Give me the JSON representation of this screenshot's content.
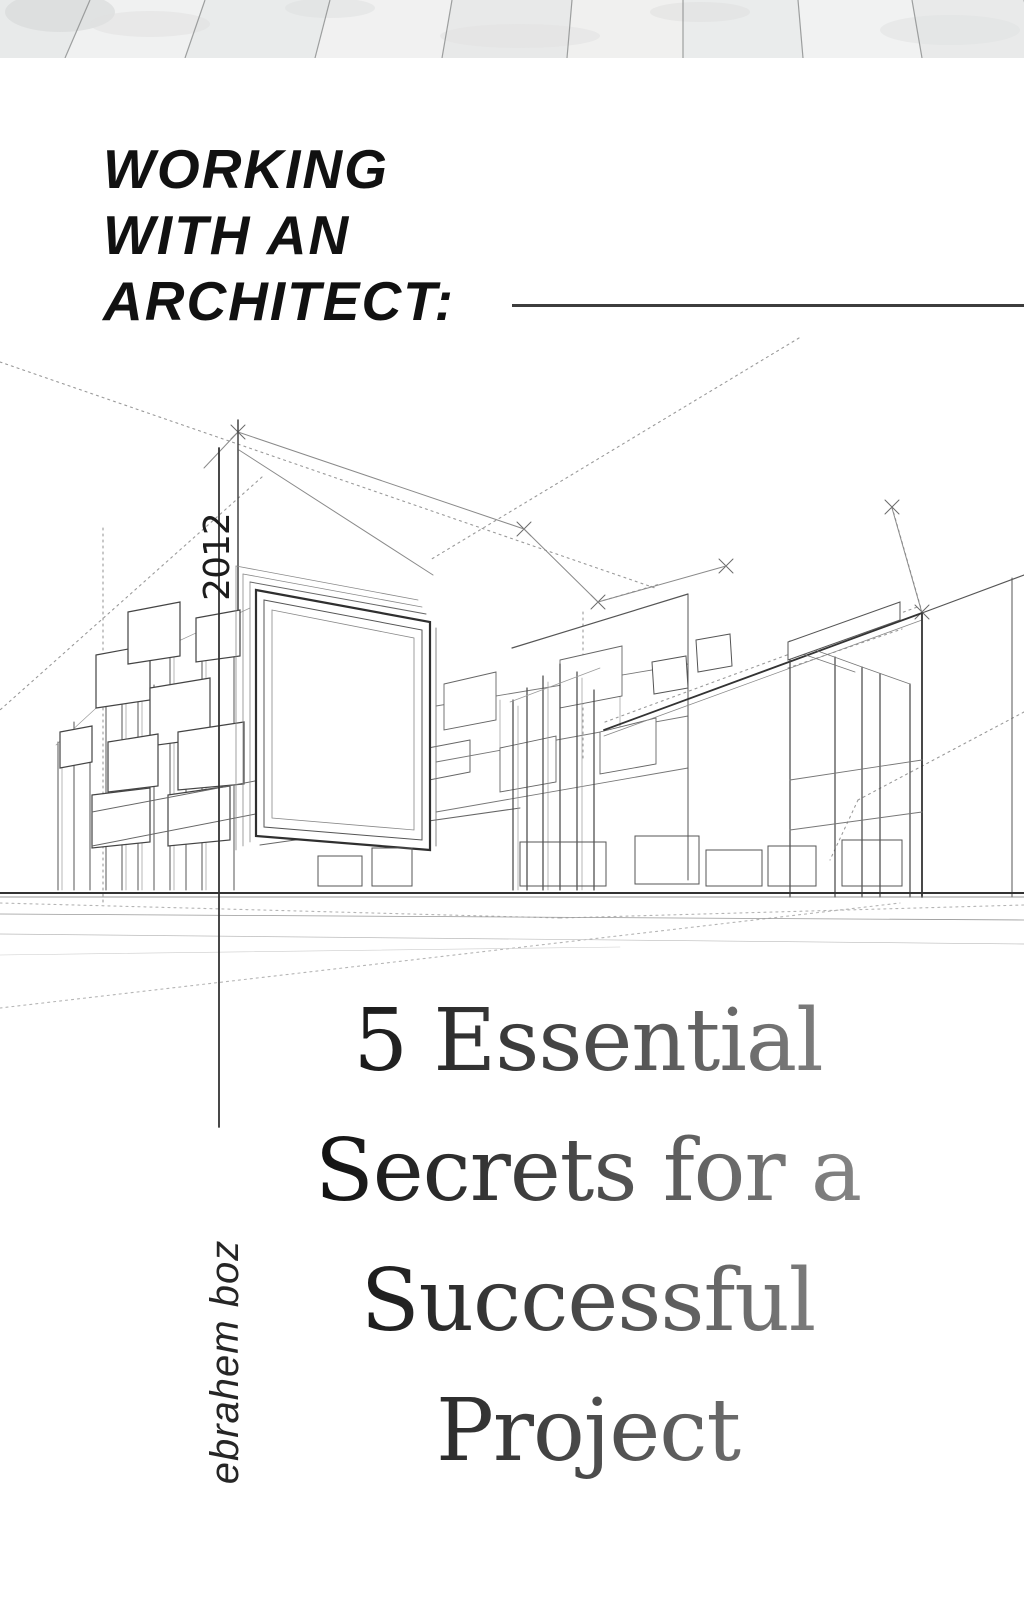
{
  "cover": {
    "title": {
      "line1": "WORKING",
      "line2": "WITH AN",
      "line3": "ARCHITECT:"
    },
    "year": "2012",
    "subtitle": {
      "line1": "5 Essential",
      "line2": "Secrets for a",
      "line3": "Successful",
      "line4": "Project"
    },
    "author": "ebrahem boz",
    "colors": {
      "title_text": "#111111",
      "rule": "#3d3d3d",
      "subtitle_gradient_dark": "#0c0c0c",
      "subtitle_gradient_light": "#8f8f8f",
      "sketch_ink": "#444444",
      "wood_plank": "#ededed"
    }
  }
}
